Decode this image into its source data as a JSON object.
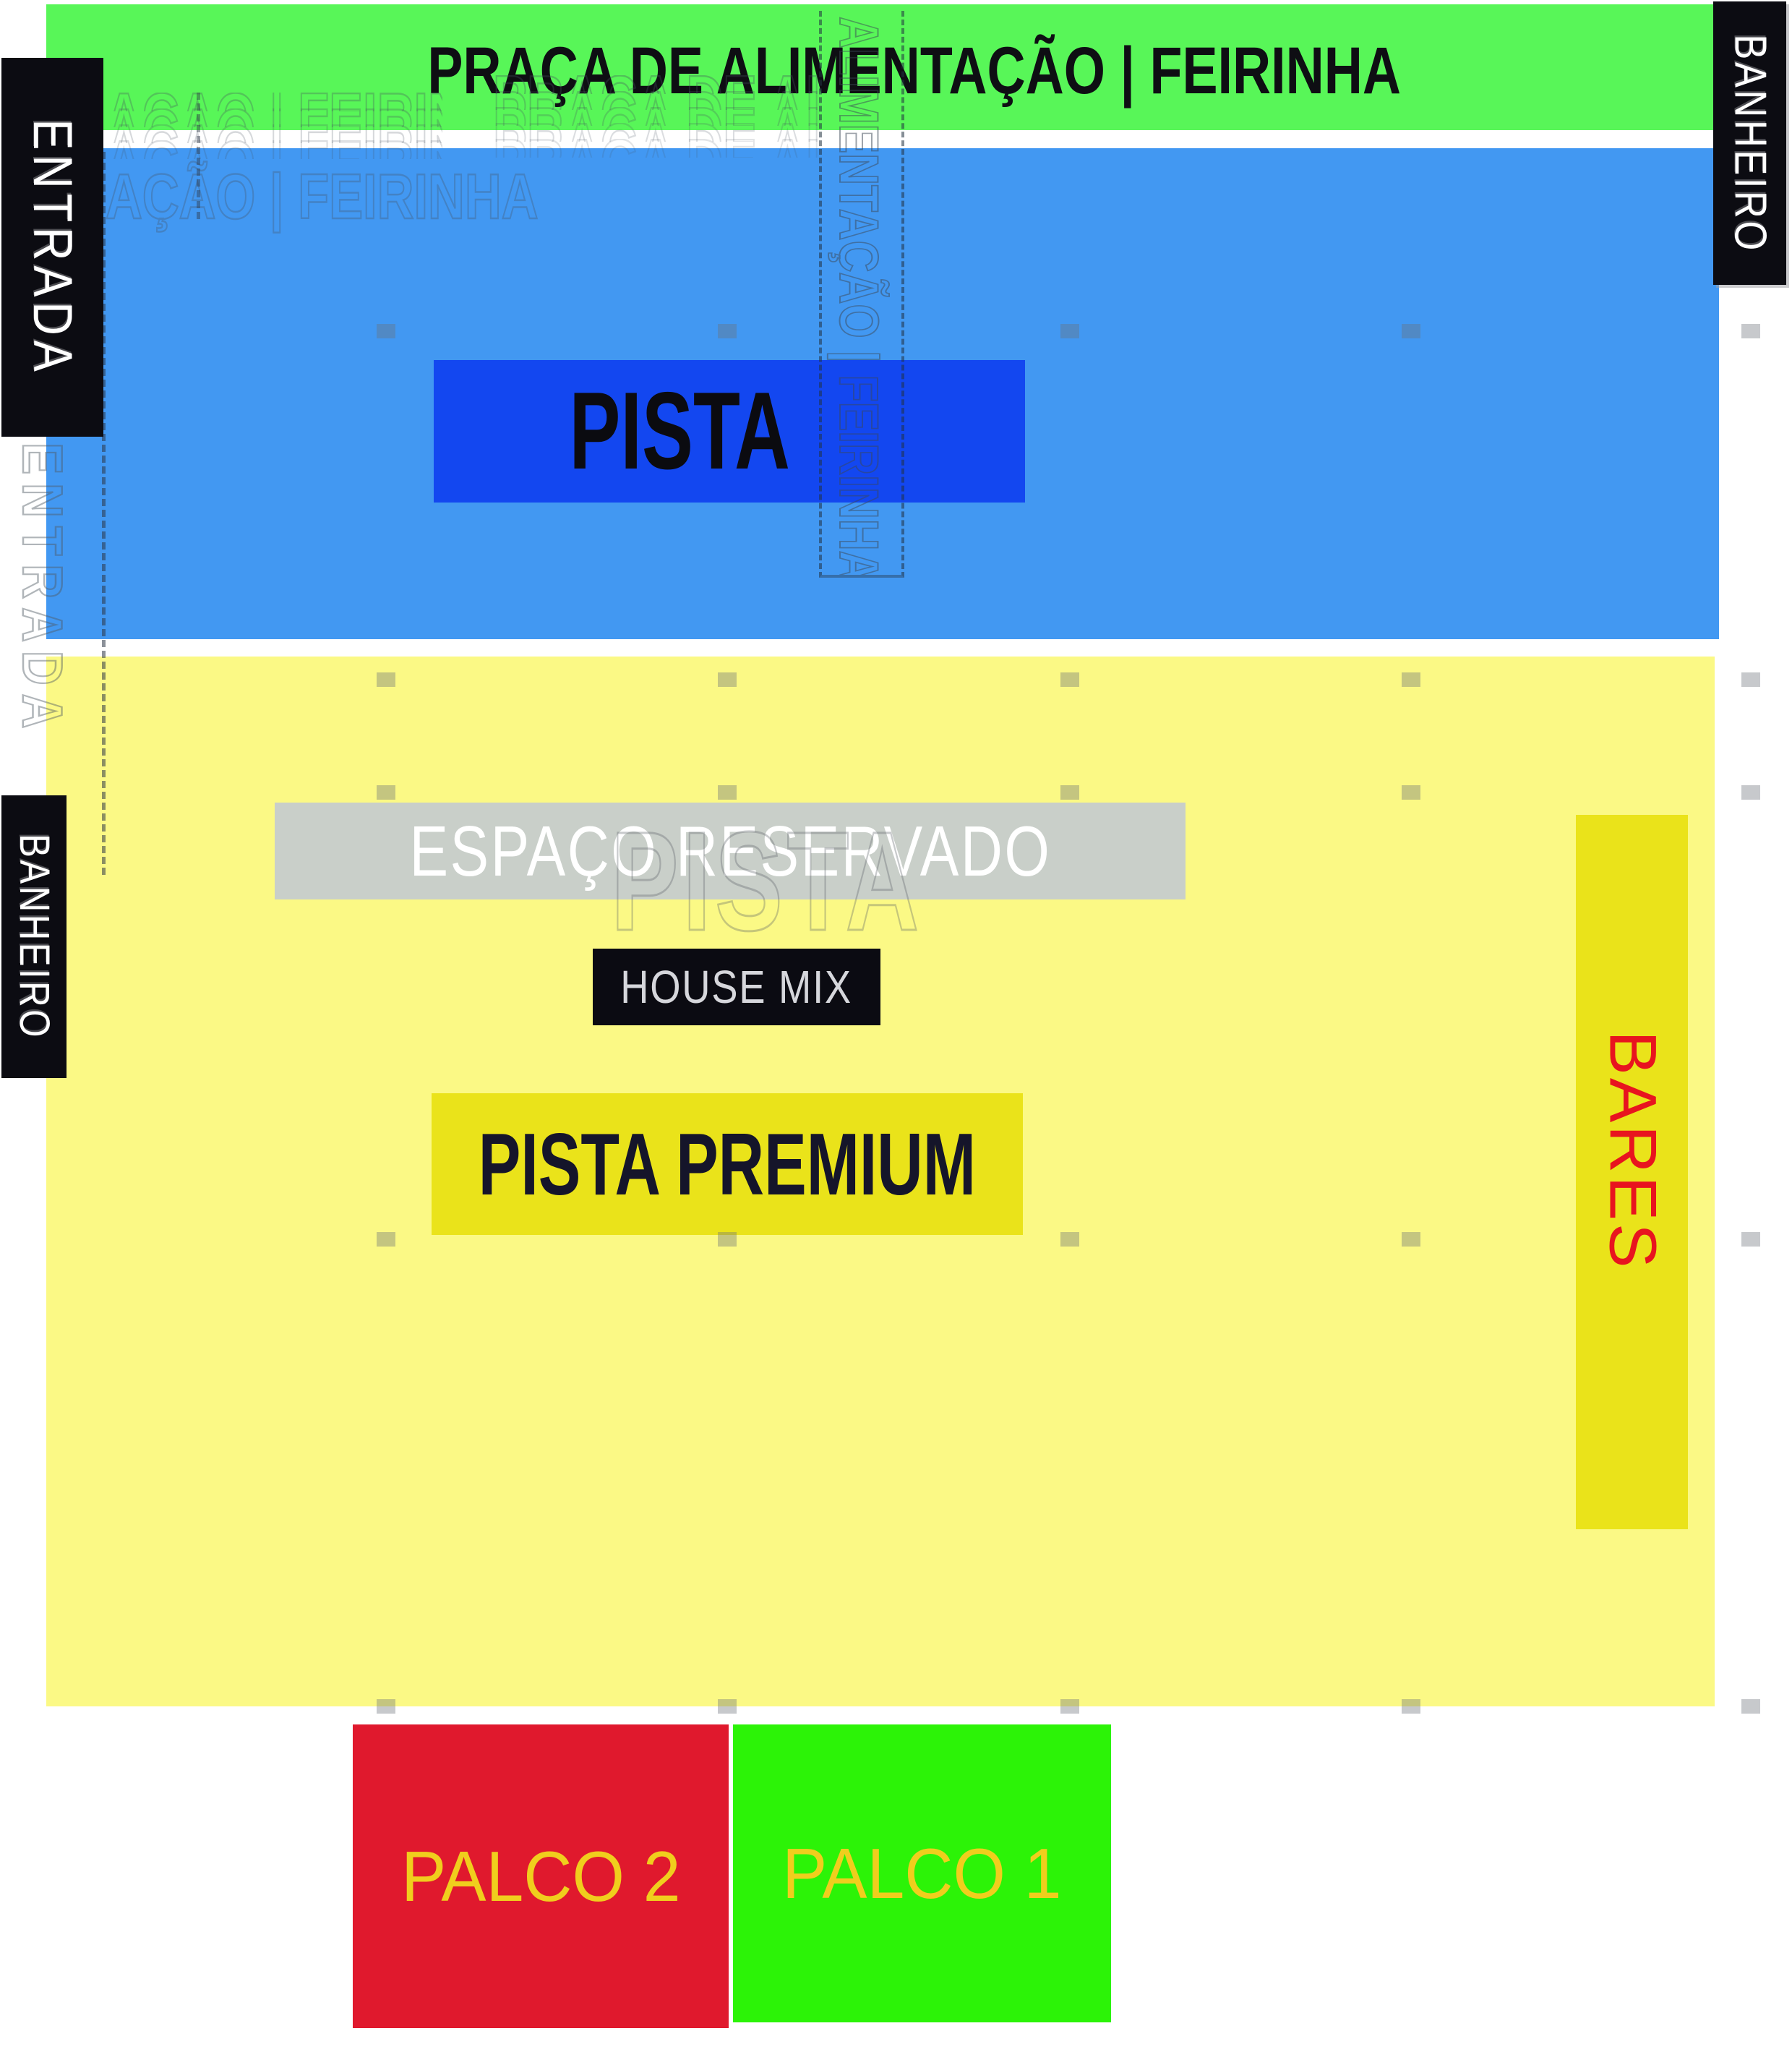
{
  "map": {
    "title": "PRAÇA DE ALIMENTAÇÃO | FEIRINHA",
    "areas": {
      "food_court": "PRAÇA DE ALIMENTAÇÃO | FEIRINHA",
      "entrance": "ENTRADA",
      "restroom_top_right": "BANHEIRO",
      "restroom_left": "BANHEIRO",
      "pista": "PISTA",
      "reserved_space": "ESPAÇO RESERVADO",
      "house_mix": "HOUSE MIX",
      "pista_premium": "PISTA PREMIUM",
      "bars": "BARES",
      "stage_2": "PALCO 2",
      "stage_1": "PALCO 1"
    },
    "ghost_artifacts": {
      "title_fragment_right": "PRAÇA DE ALIMENTAÇÃO | FEIRINHA",
      "title_fragment_left": "AÇÃO | FEIRINHA",
      "vertical_strip_text": "ALIMENTAÇÃO | FEIRINHA",
      "entrance_ghost": "ENTRADA",
      "pista_ghost": "PISTA"
    },
    "colors": {
      "food_court_green": "#58f658",
      "crowd_blue": "#4298f2",
      "pista_blue": "#1347f0",
      "grounds_yellow": "#fbf985",
      "premium_yellow": "#eae31a",
      "reserved_gray": "#c9cfc9",
      "label_black": "#0c0c12",
      "stage2_red": "#e0192d",
      "stage1_green": "#2cf307",
      "stage_text_gold": "#f0ce1d",
      "bars_text_red": "#e8141f"
    }
  }
}
